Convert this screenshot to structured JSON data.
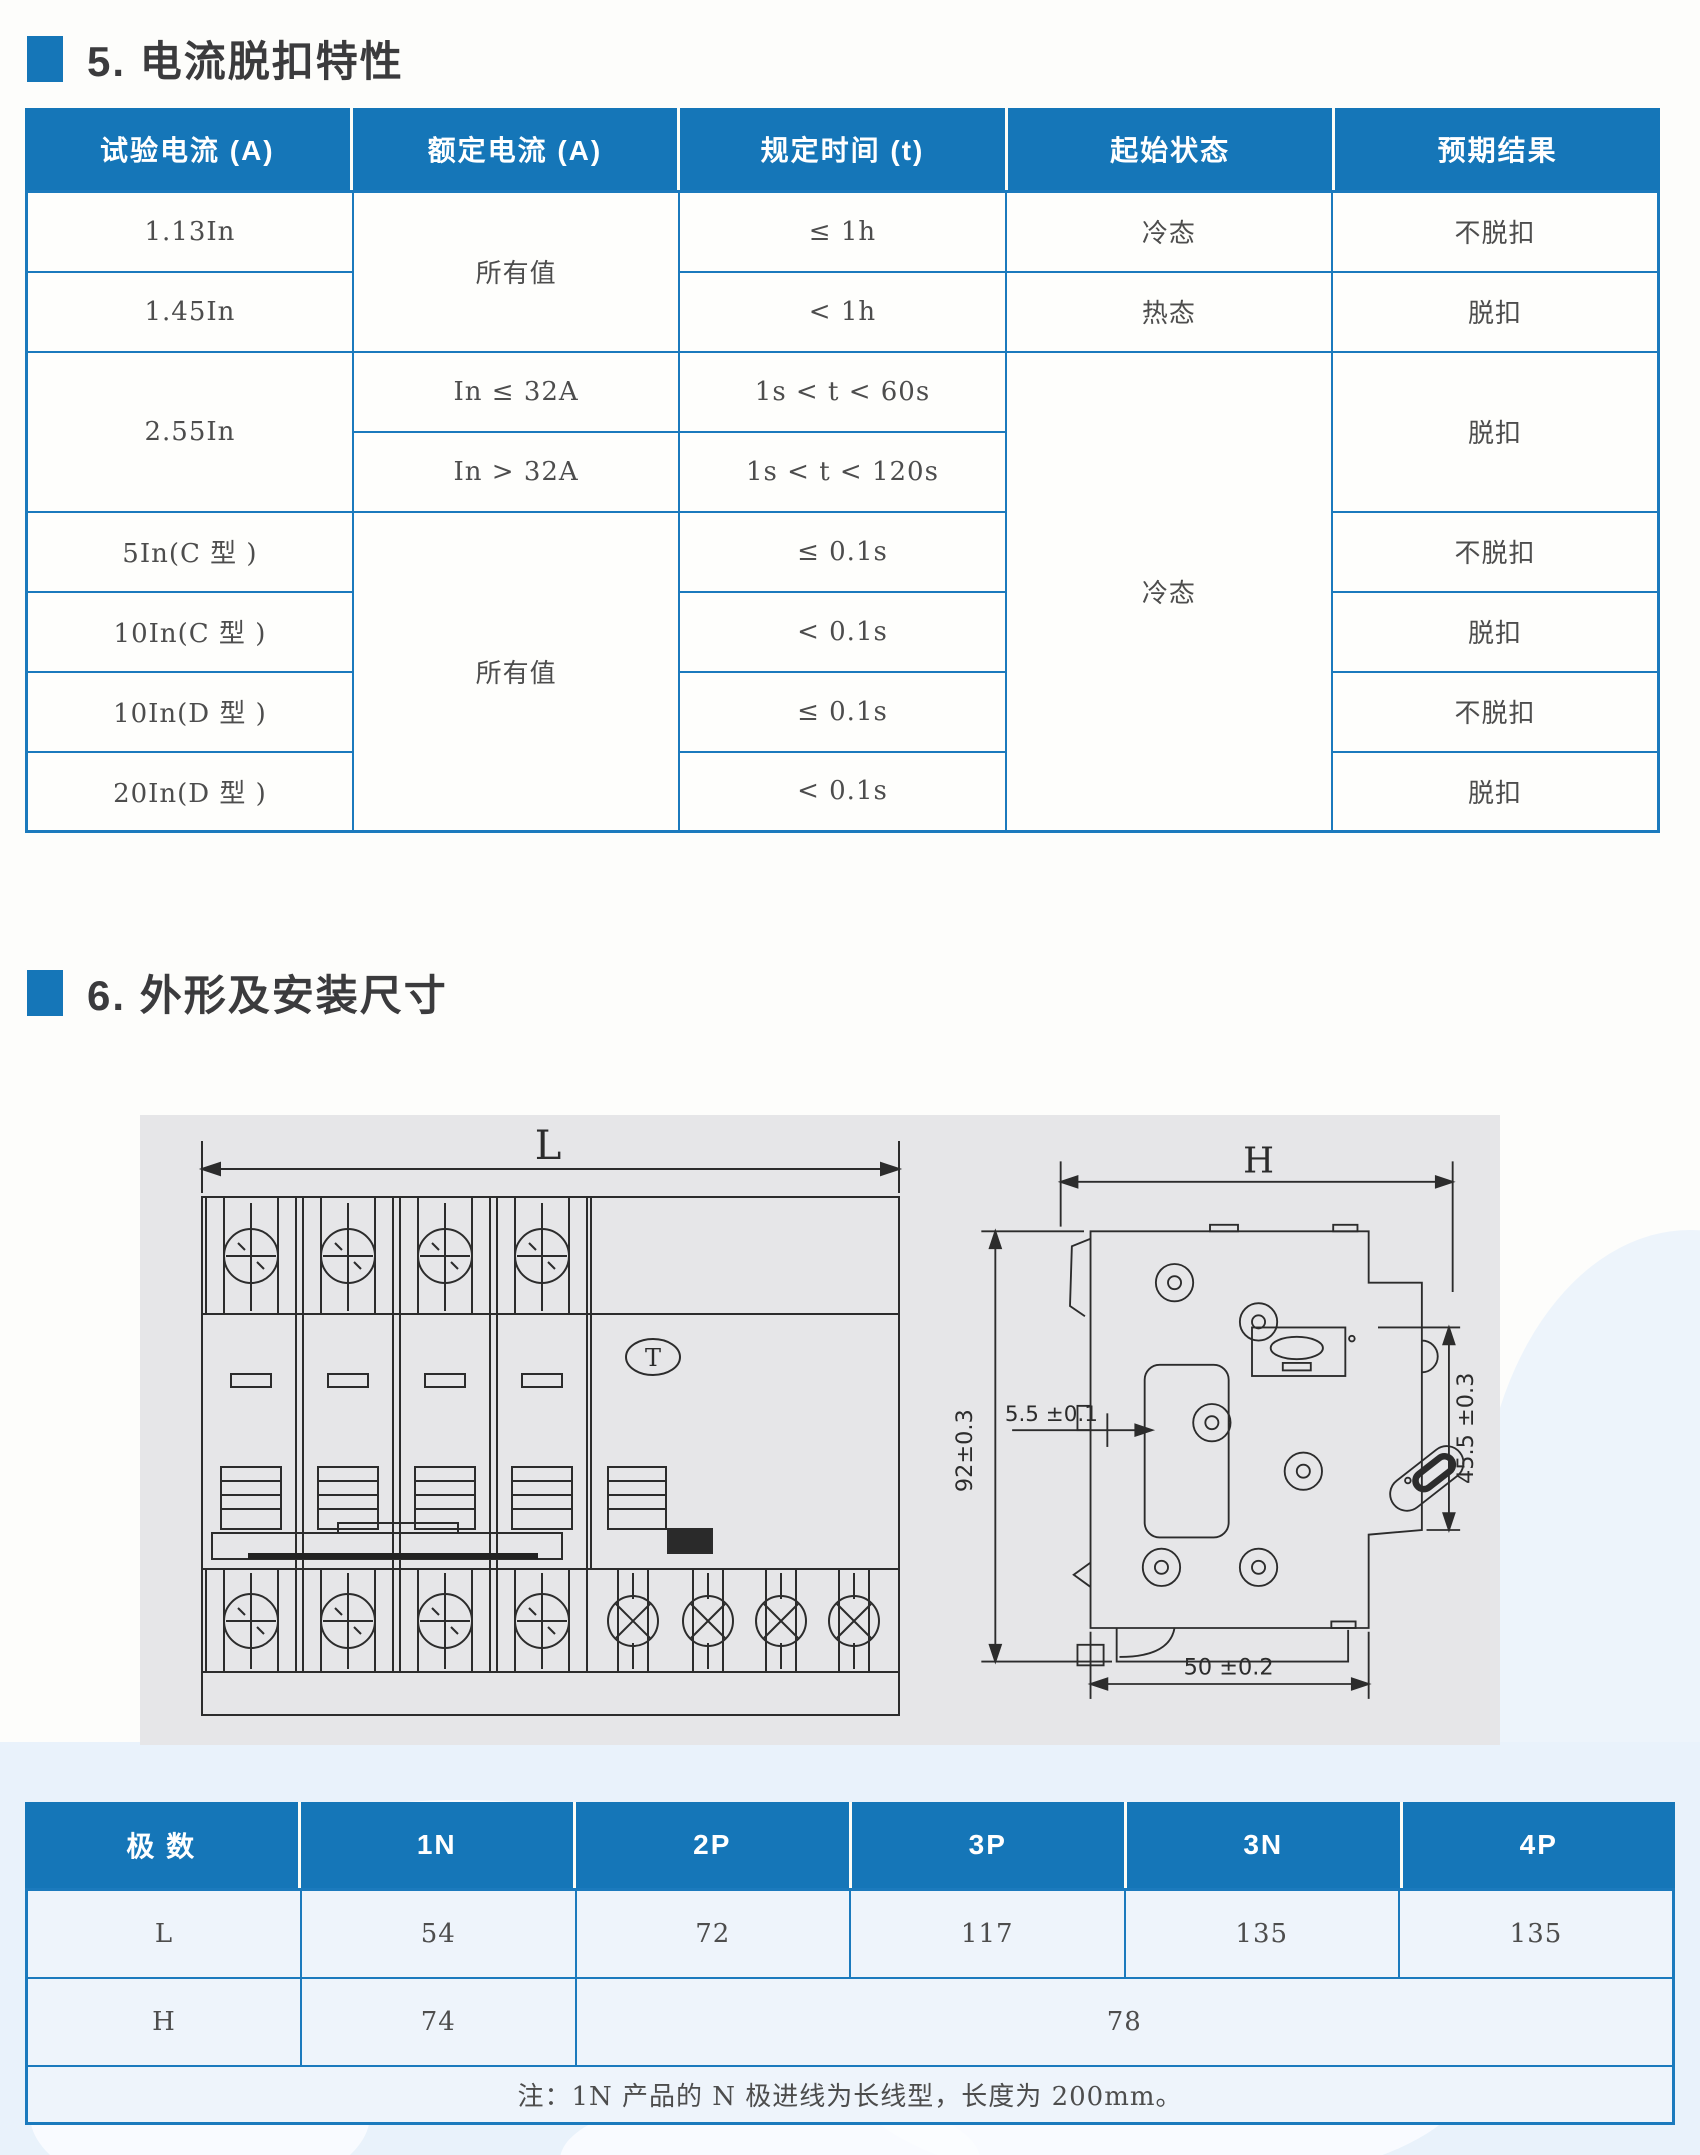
{
  "colors": {
    "accent_blue": "#1576b8",
    "table_border_blue": "#1b7abd",
    "panel_gray": "#e6e6e8",
    "watermark_blue": "#e9f2fb",
    "title_gray": "#3b3b3d"
  },
  "section5": {
    "title": "5. 电流脱扣特性"
  },
  "trip_table": {
    "headers": [
      "试验电流 (A)",
      "额定电流 (A)",
      "规定时间 (t)",
      "起始状态",
      "预期结果"
    ],
    "r1": {
      "test": "1.13In",
      "rated": "所有值",
      "time": "≤ 1h",
      "state": "冷态",
      "result": "不脱扣"
    },
    "r2": {
      "test": "1.45In",
      "time": "< 1h",
      "state": "热态",
      "result": "脱扣"
    },
    "r3": {
      "test": "2.55In",
      "rated": "In ≤ 32A",
      "time": "1s < t < 60s",
      "state": "冷态",
      "result": "脱扣"
    },
    "r4": {
      "rated": "In > 32A",
      "time": "1s < t < 120s"
    },
    "r5": {
      "test": "5In(C 型 )",
      "rated": "所有值",
      "time": "≤ 0.1s",
      "result": "不脱扣"
    },
    "r6": {
      "test": "10In(C 型 )",
      "time": "< 0.1s",
      "result": "脱扣"
    },
    "r7": {
      "test": "10In(D 型 )",
      "time": "≤ 0.1s",
      "result": "不脱扣"
    },
    "r8": {
      "test": "20In(D 型 )",
      "time": "< 0.1s",
      "result": "脱扣"
    }
  },
  "section6": {
    "title": "6. 外形及安装尺寸"
  },
  "drawing": {
    "label_l": "L",
    "label_h": "H",
    "dim_height": "92±0.3",
    "dim_rail": "5.5 ±0.1",
    "dim_right": "45.5 ±0.3",
    "dim_width": "50 ±0.2",
    "test_button": "T"
  },
  "dim_table": {
    "col_header": "极 数",
    "pole_headers": [
      "1N",
      "2P",
      "3P",
      "3N",
      "4P"
    ],
    "l_row": {
      "label": "L",
      "values": [
        "54",
        "72",
        "117",
        "135",
        "135"
      ]
    },
    "h_row": {
      "label": "H",
      "value_1n": "74",
      "value_rest": "78"
    },
    "note": "注：1N 产品的 N 极进线为长线型，长度为 200mm。"
  }
}
